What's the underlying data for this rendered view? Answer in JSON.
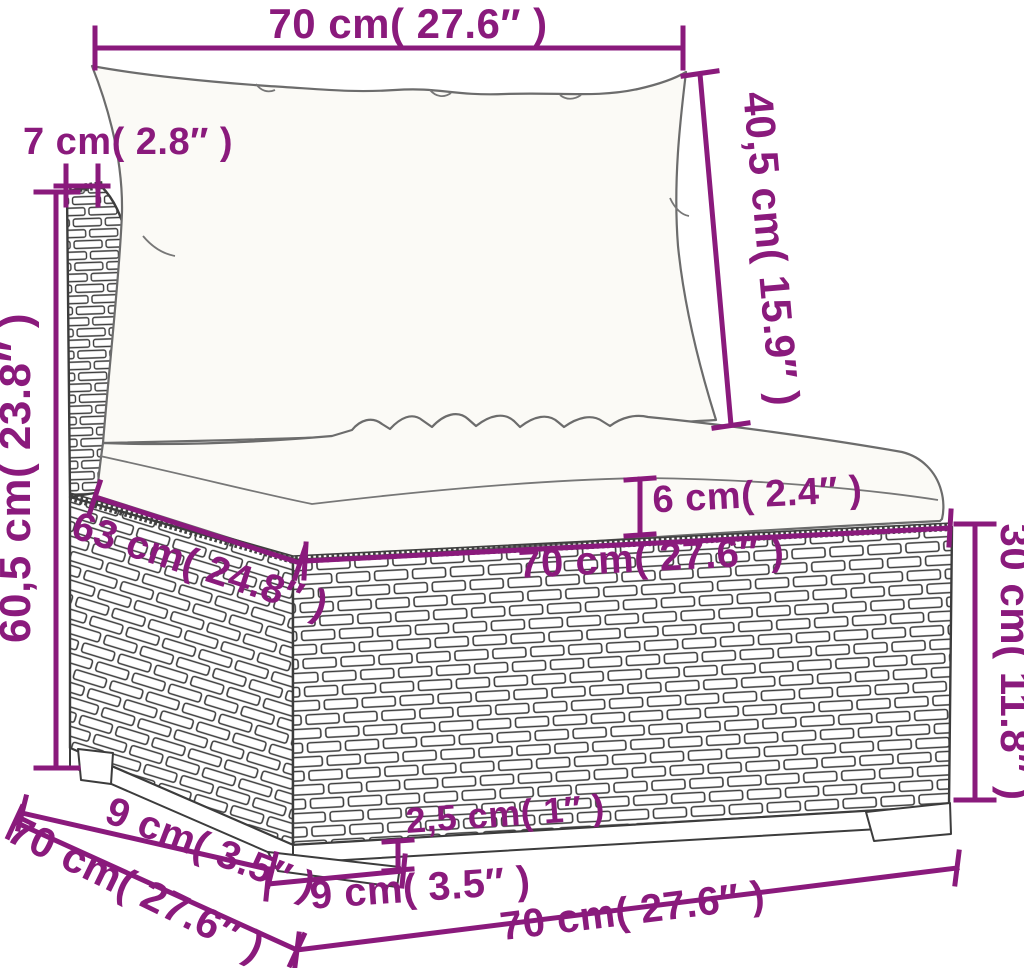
{
  "figure": {
    "kind": "product-dimension-diagram",
    "subject": "wicker sofa middle section with back and seat cushions",
    "units_shown": "cm and inches"
  },
  "colors": {
    "dimension_accent": "#8a1a7c",
    "line_art": "#454545",
    "background": "#ffffff"
  },
  "dimensions": {
    "top_width": "70 cm( 27.6″ )",
    "back_panel_thickness": "7 cm( 2.8″ )",
    "overall_height": "60,5 cm( 23.8″ )",
    "backrest_height": "40,5 cm( 15.9″ )",
    "seat_cushion_thickness": "6 cm( 2.4″ )",
    "seat_front_width": "63 cm( 24.8″ )",
    "base_width": "70 cm( 27.6″ )",
    "base_height": "30 cm( 11.8″ )",
    "foot_inset_depth": "9 cm( 3.5″ )",
    "side_depth": "70 cm( 27.6″ )",
    "foot_height": "2,5 cm( 1″ )",
    "foot_width": "9 cm( 3.5″ )",
    "bottom_width": "70 cm( 27.6″ )"
  }
}
